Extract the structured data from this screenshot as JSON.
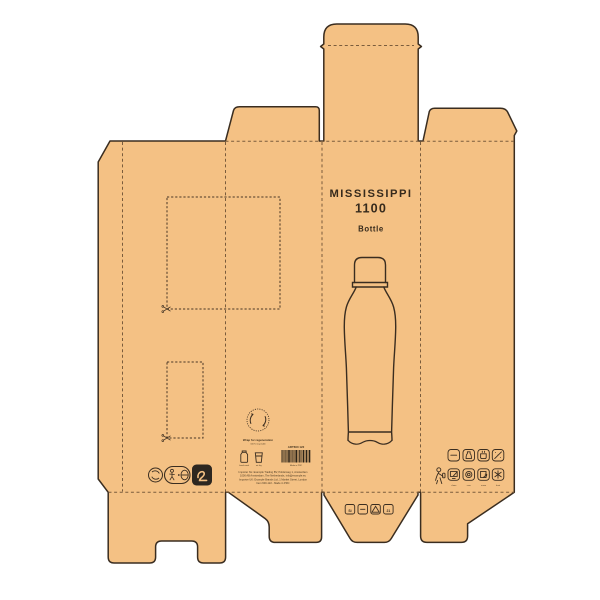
{
  "colors": {
    "board": "#f4c184",
    "outline": "#3a2d20",
    "fold_line": "#7a5c3c",
    "ink": "#43331f",
    "badge_black": "#2d2720",
    "background": "#ffffff"
  },
  "front_panel": {
    "title": "MISSISSIPPI",
    "model": "1100",
    "subtitle": "Bottle"
  },
  "eco_stamp": {
    "line1": "Wrap for regeneration",
    "line2": "100% recyclable"
  },
  "care_icons": [
    {
      "name": "hand-wash-icon",
      "label": "hand wash"
    },
    {
      "name": "air-dry-icon",
      "label": "air dry"
    }
  ],
  "barcode": {
    "top_label": "ART600 122",
    "bottom_label": "Made in PRC"
  },
  "legal_lines": [
    "Importer NL: Example Trading BV, Polderweg 1, Amsterdam",
    "1000 AB Amsterdam, The Netherlands, info@example.eu",
    "Importer UK: Example Brands Ltd, 1 Market Street, London",
    "Item 600-122 - Made in PRC"
  ],
  "feature_icons": {
    "row1": [
      {
        "name": "capacity-icon"
      },
      {
        "name": "bottle-icon"
      },
      {
        "name": "hot-drink-icon"
      },
      {
        "name": "dishwasher-icon"
      }
    ],
    "row2": [
      {
        "name": "print-area-icon"
      },
      {
        "name": "double-wall-icon"
      },
      {
        "name": "reuse-icon"
      },
      {
        "name": "frost-icon"
      }
    ],
    "labels": [
      "clean",
      "care",
      "reuse",
      "frost"
    ]
  },
  "material_codes": {
    "c1": "Si",
    "c4": "21"
  },
  "markers": {
    "scissors": "scissors-icon",
    "recycle_triangle": "recycle-triangle-icon",
    "tidyman": "tidyman-icon",
    "eco_loop": "recycle-loop-icon",
    "black_badge_glyph": "paper-grade-icon",
    "person": "person-care-icon"
  }
}
